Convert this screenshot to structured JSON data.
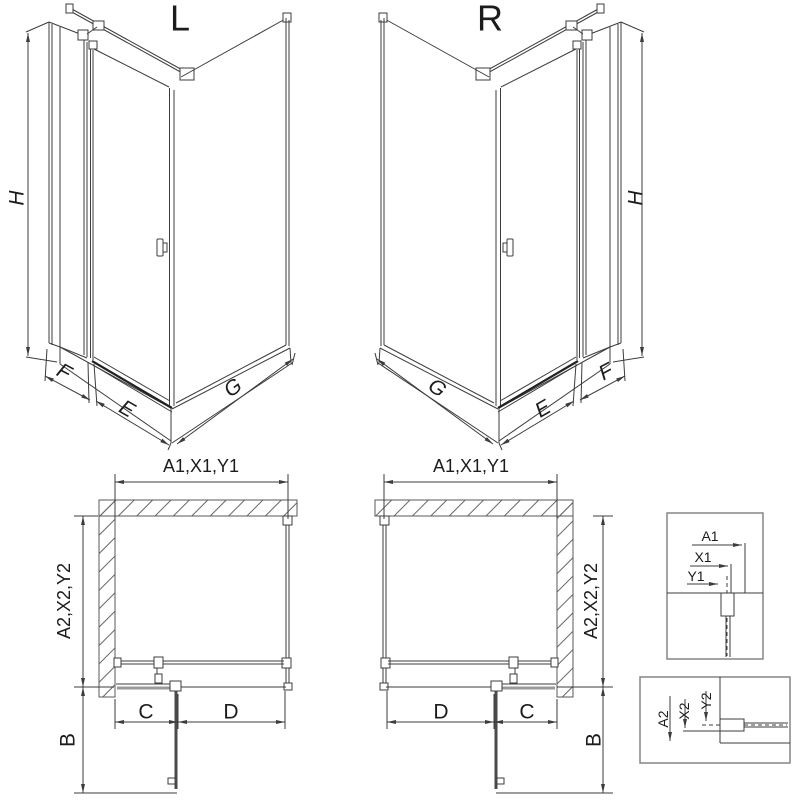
{
  "drawing": {
    "iso_left": {
      "title": "L",
      "height_label": "H",
      "panel_label": "F",
      "door_label": "E",
      "side_label": "G"
    },
    "iso_right": {
      "title": "R",
      "height_label": "H",
      "panel_label": "F",
      "door_label": "E",
      "side_label": "G"
    },
    "plan_left": {
      "width_label": "A1,X1,Y1",
      "depth_label": "A2,X2,Y2",
      "fixed_label": "C",
      "door_label": "D",
      "swing_label": "B"
    },
    "plan_right": {
      "width_label": "A1,X1,Y1",
      "depth_label": "A2,X2,Y2",
      "fixed_label": "C",
      "door_label": "D",
      "swing_label": "B"
    },
    "detail_width": {
      "a": "A1",
      "x": "X1",
      "y": "Y1"
    },
    "detail_depth": {
      "a": "A2",
      "x": "X2",
      "y": "Y2"
    }
  }
}
